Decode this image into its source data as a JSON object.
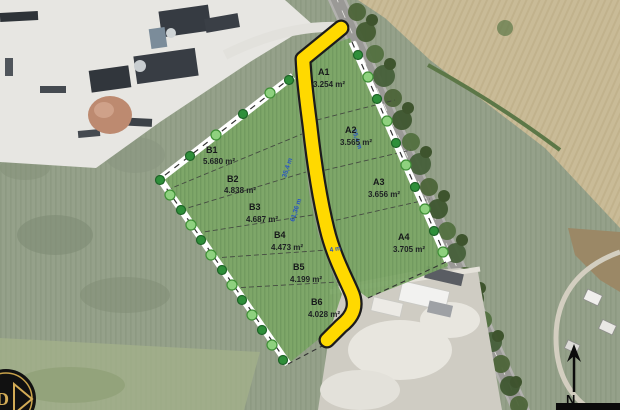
{
  "parcels": {
    "a": [
      {
        "id": "A1",
        "area": "3.254 m²"
      },
      {
        "id": "A2",
        "area": "3.565 m²"
      },
      {
        "id": "A3",
        "area": "3.656 m²"
      },
      {
        "id": "A4",
        "area": "3.705 m²"
      }
    ],
    "b": [
      {
        "id": "B1",
        "area": "5.680 m²"
      },
      {
        "id": "B2",
        "area": "4.838 m²"
      },
      {
        "id": "B3",
        "area": "4.687 m²"
      },
      {
        "id": "B4",
        "area": "4.473 m²"
      },
      {
        "id": "B5",
        "area": "4.199 m²"
      },
      {
        "id": "B6",
        "area": "4.028 m²"
      }
    ]
  },
  "measurements": {
    "m1": "35,4 m",
    "m2": "61,36 m",
    "m3": "4 m",
    "m4": "55,4 m"
  },
  "compass": {
    "north_label": "N"
  },
  "logo": {
    "letter": "D"
  },
  "colors": {
    "highlight_road": "#FFD900",
    "highlight_outline": "#1c1c1c",
    "parcel_green": "#7ca766",
    "tree_dark": "#2f8f3a",
    "tree_light": "#8ed17e",
    "band_white": "#ffffff"
  }
}
